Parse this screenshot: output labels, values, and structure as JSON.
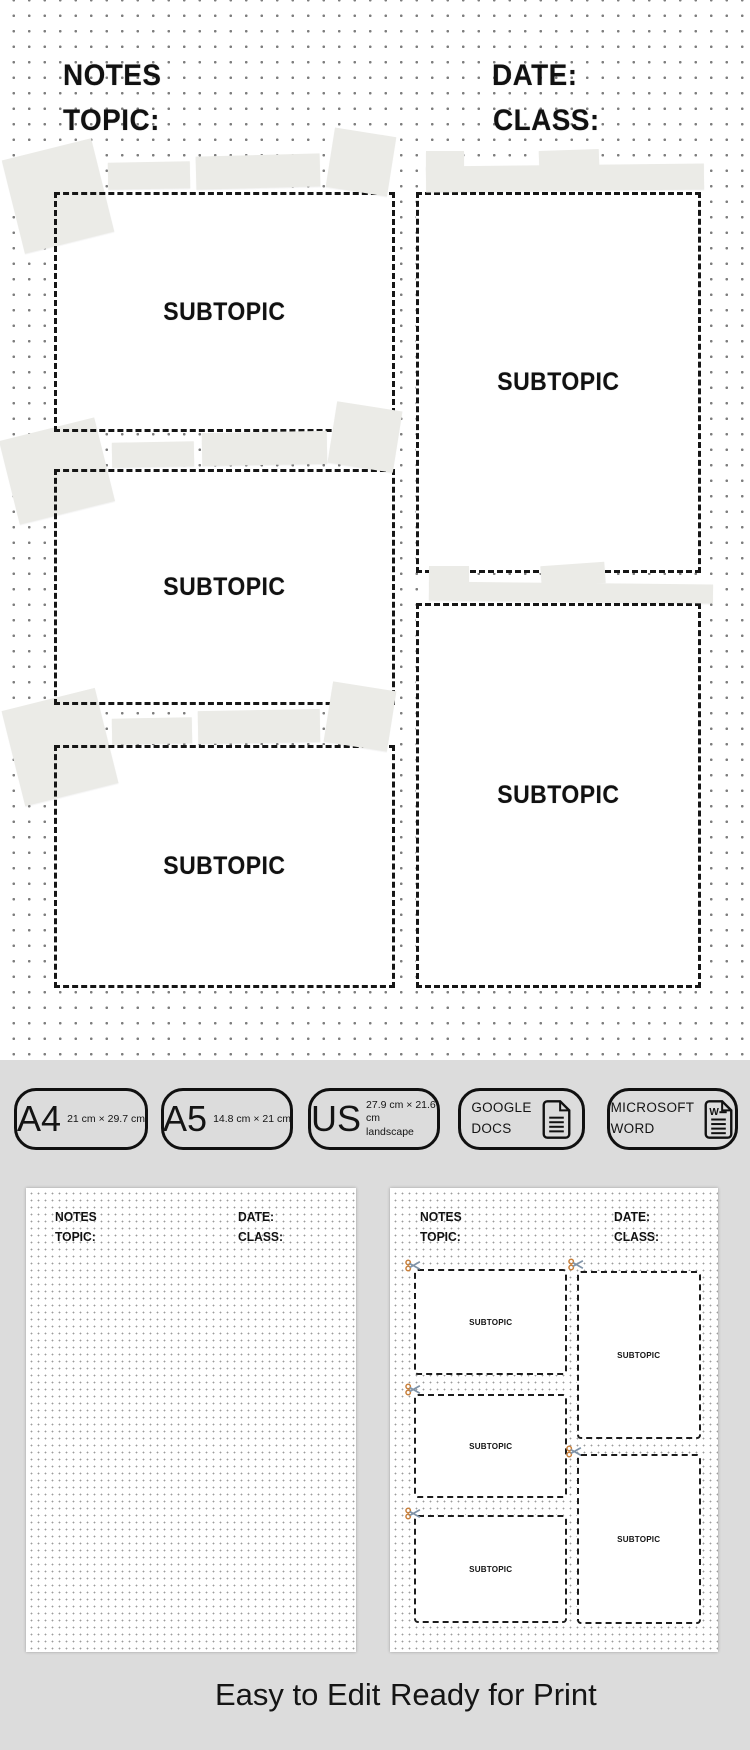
{
  "page": {
    "header": {
      "notes": "NOTES",
      "topic": "TOPIC:",
      "date": "DATE:",
      "class": "CLASS:"
    },
    "subtopic_label": "SUBTOPIC",
    "colors": {
      "page_background": "#ffffff",
      "footer_background": "#dcdcdc",
      "tape": "#ebebe7",
      "dashed_border": "#161616",
      "dot_grid": "#7d7d7d",
      "scissors_handle": "#c8803c",
      "scissors_blade": "#7f93a8"
    }
  },
  "badges": [
    {
      "id": "a4",
      "big": "A4",
      "small": "21 cm × 29.7 cm"
    },
    {
      "id": "a5",
      "big": "A5",
      "small": "14.8 cm × 21 cm"
    },
    {
      "id": "us",
      "big": "US",
      "small_line1": "27.9 cm × 21.6 cm",
      "small_line2": "landscape"
    },
    {
      "id": "google-docs",
      "line1": "GOOGLE",
      "line2": "DOCS",
      "icon": "document-icon"
    },
    {
      "id": "microsoft-word",
      "line1": "MICROSOFT",
      "line2": "WORD",
      "icon": "word-document-icon"
    }
  ],
  "thumbnails": {
    "left": {
      "header": {
        "notes": "NOTES",
        "topic": "TOPIC:",
        "date": "DATE:",
        "class": "CLASS:"
      }
    },
    "right": {
      "header": {
        "notes": "NOTES",
        "topic": "TOPIC:",
        "date": "DATE:",
        "class": "CLASS:"
      },
      "subtopic_label": "SUBTOPIC",
      "scissors_icon": "scissors-icon"
    }
  },
  "captions": {
    "left": "Easy to Edit",
    "right": "Ready for Print"
  }
}
